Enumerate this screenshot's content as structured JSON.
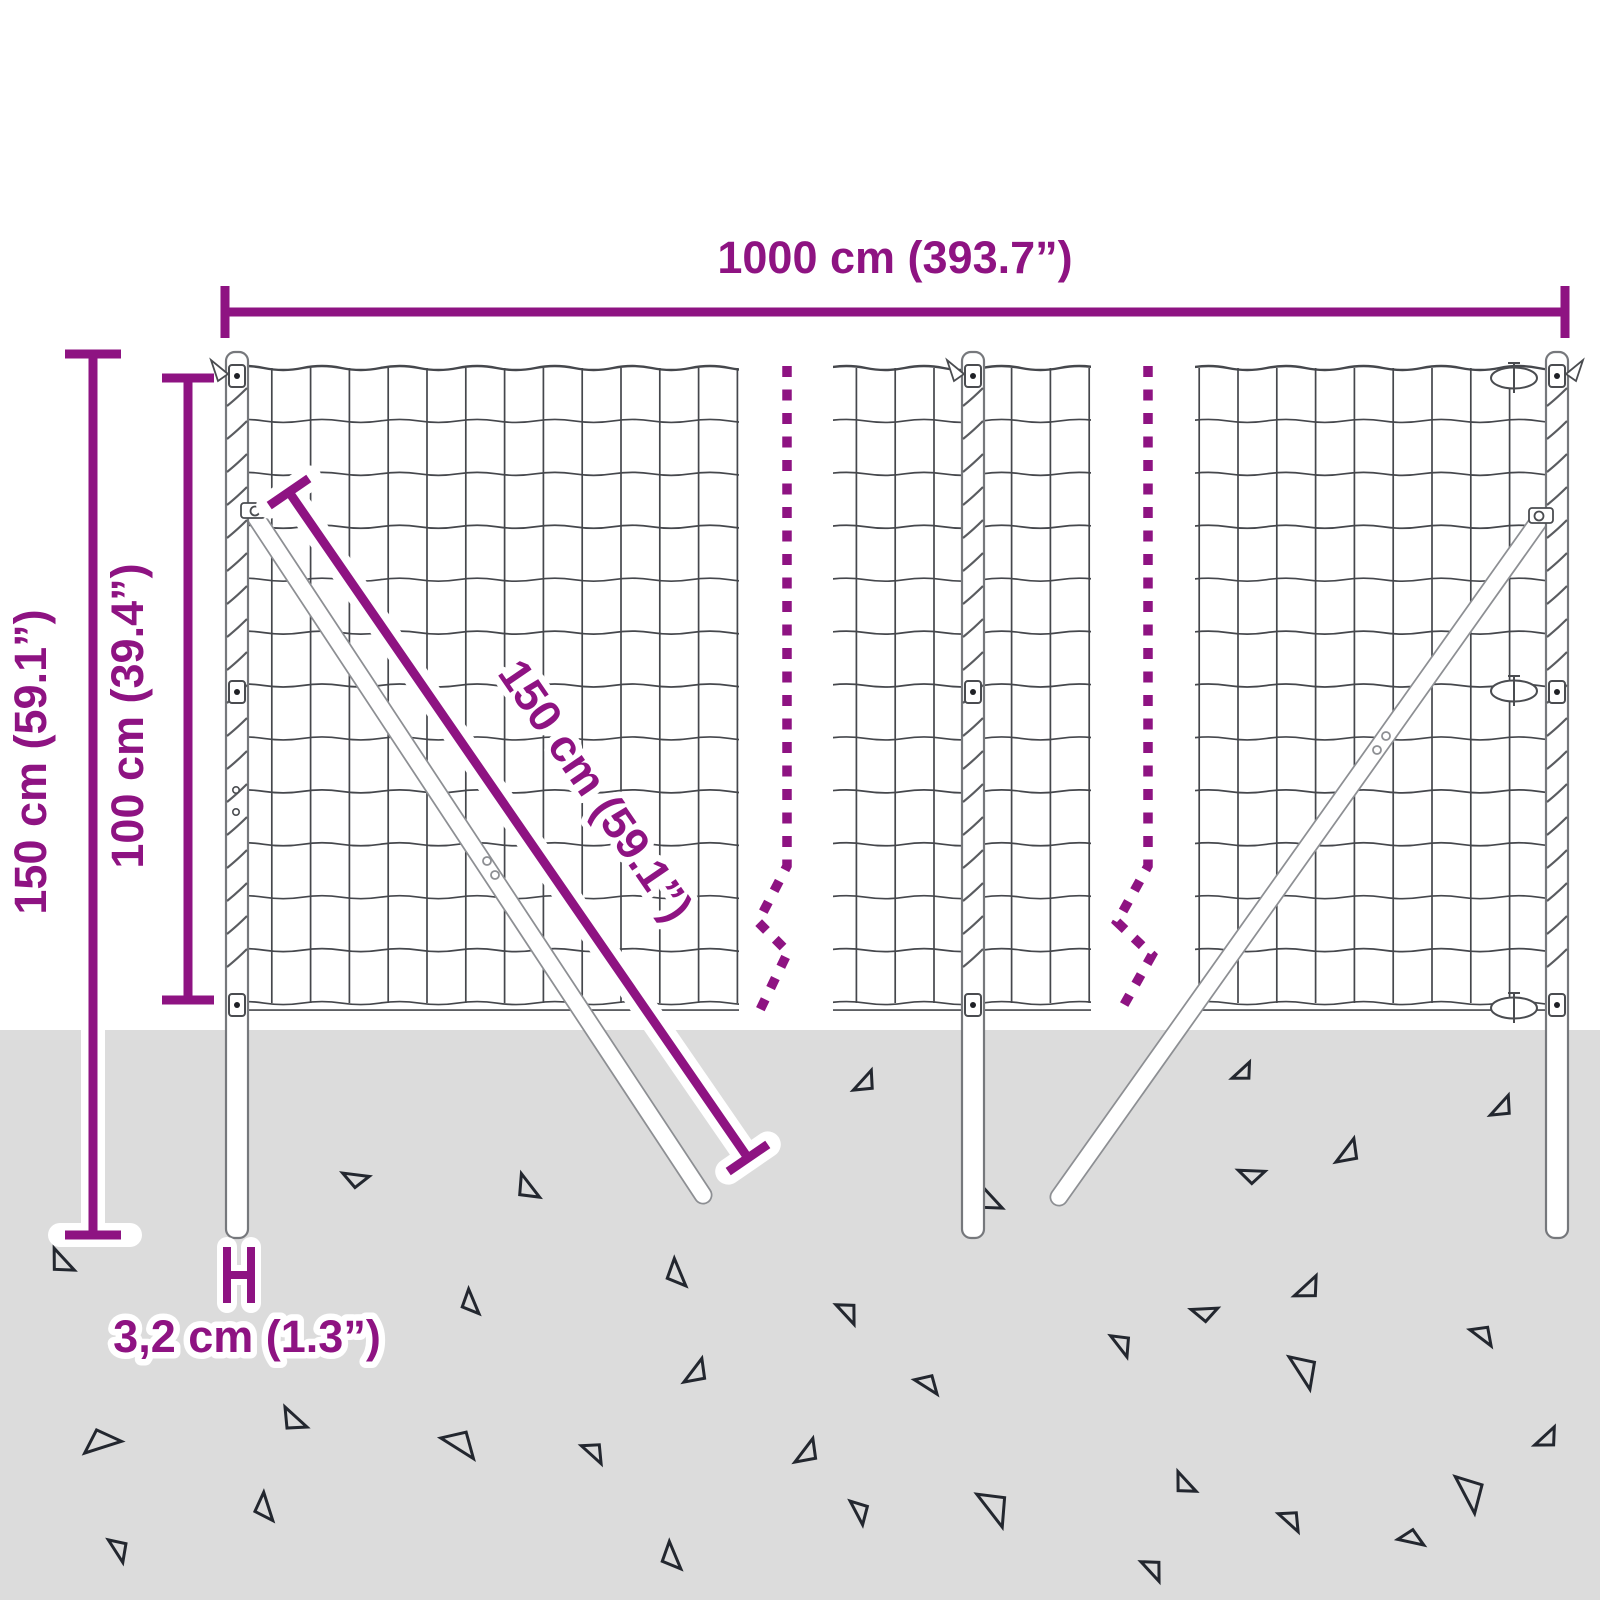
{
  "labels": {
    "width": "1000 cm (393.7”)",
    "total_height": "150 cm (59.1”)",
    "mesh_height": "100 cm (39.4”)",
    "strut_length": "150 cm (59.1”)",
    "post_diameter": "3,2 cm (1.3”)"
  },
  "colors": {
    "accent": "#8e1382",
    "background": "#ffffff",
    "ground": "#dcdcdc",
    "mesh": "#45474c",
    "post_stroke": "#76787c",
    "spiral": "#5a5c60",
    "strut_stroke": "#8d8f93",
    "clamp": "#4a4c50",
    "dot": "#1f2126",
    "triangle": "#23272f"
  },
  "figure": {
    "canvas": {
      "w": 1600,
      "h": 1600
    },
    "ground_y": 1030,
    "mesh": {
      "top_y": 368,
      "row_step": 52.92,
      "rows": 12,
      "col_step": 38.8,
      "bottom_double_offset": 7,
      "panels": [
        {
          "x1": 231,
          "x2": 739,
          "vx0": 233
        },
        {
          "x1": 833,
          "x2": 1091,
          "vx0": 856.4
        },
        {
          "x1": 1195,
          "x2": 1550,
          "vx0": 1199.2
        }
      ]
    },
    "posts": [
      {
        "cx": 237,
        "top": 352,
        "bottom": 1238,
        "flag": "left",
        "holes": true,
        "pivot": "right",
        "tensioners": false
      },
      {
        "cx": 973,
        "top": 352,
        "bottom": 1238,
        "flag": "left",
        "holes": false,
        "pivot": null,
        "tensioners": false
      },
      {
        "cx": 1557,
        "top": 352,
        "bottom": 1238,
        "flag": "right",
        "holes": false,
        "pivot": "left",
        "tensioners": true
      }
    ],
    "clamp_ys": [
      376,
      692,
      1005
    ],
    "tensioner_ys": [
      378,
      691,
      1008
    ],
    "spirals": {
      "y0": 396,
      "y1": 988,
      "step": 33
    },
    "struts": [
      {
        "x1": 253,
        "y1": 513,
        "x2": 703,
        "y2": 1195,
        "plate": [
          [
            487,
            861
          ],
          [
            495,
            875
          ]
        ]
      },
      {
        "x1": 1541,
        "y1": 518,
        "x2": 1059,
        "y2": 1197,
        "plate": [
          [
            1386,
            736
          ],
          [
            1377,
            750
          ]
        ]
      }
    ],
    "dashed": [
      "M787 366 V866 L758 922 L788 952 L759 1012",
      "M1148 366 V866 L1117 922 L1152 955 L1120 1012"
    ],
    "triangles": [
      [
        356,
        1178,
        0.9,
        -35
      ],
      [
        62,
        1262,
        1.0,
        5
      ],
      [
        471,
        1303,
        0.9,
        25
      ],
      [
        294,
        1420,
        1.0,
        0
      ],
      [
        101,
        1443,
        1.3,
        120
      ],
      [
        459,
        1444,
        1.3,
        170
      ],
      [
        265,
        1508,
        1.0,
        30
      ],
      [
        118,
        1549,
        0.9,
        195
      ],
      [
        528,
        1188,
        1.0,
        10
      ],
      [
        677,
        1274,
        1.0,
        25
      ],
      [
        847,
        1312,
        0.9,
        185
      ],
      [
        696,
        1372,
        1.0,
        -95
      ],
      [
        927,
        1384,
        0.9,
        170
      ],
      [
        593,
        1452,
        0.9,
        180
      ],
      [
        807,
        1452,
        1.0,
        -95
      ],
      [
        859,
        1511,
        0.9,
        200
      ],
      [
        672,
        1557,
        1.0,
        25
      ],
      [
        993,
        1507,
        1.4,
        190
      ],
      [
        990,
        1200,
        1.0,
        5
      ],
      [
        1348,
        1152,
        1.0,
        -95
      ],
      [
        1252,
        1174,
        0.9,
        -40
      ],
      [
        1502,
        1107,
        0.9,
        -90
      ],
      [
        1308,
        1288,
        1.0,
        -85
      ],
      [
        1205,
        1312,
        0.9,
        -45
      ],
      [
        1121,
        1344,
        0.9,
        190
      ],
      [
        1482,
        1335,
        0.9,
        175
      ],
      [
        1303,
        1370,
        1.3,
        195
      ],
      [
        1547,
        1438,
        0.9,
        -85
      ],
      [
        1185,
        1484,
        0.9,
        5
      ],
      [
        1469,
        1492,
        1.4,
        200
      ],
      [
        1290,
        1520,
        0.9,
        180
      ],
      [
        1411,
        1539,
        0.9,
        150
      ],
      [
        1152,
        1569,
        0.9,
        185
      ],
      [
        865,
        1082,
        0.9,
        -90
      ],
      [
        1243,
        1072,
        0.8,
        -85
      ]
    ]
  }
}
